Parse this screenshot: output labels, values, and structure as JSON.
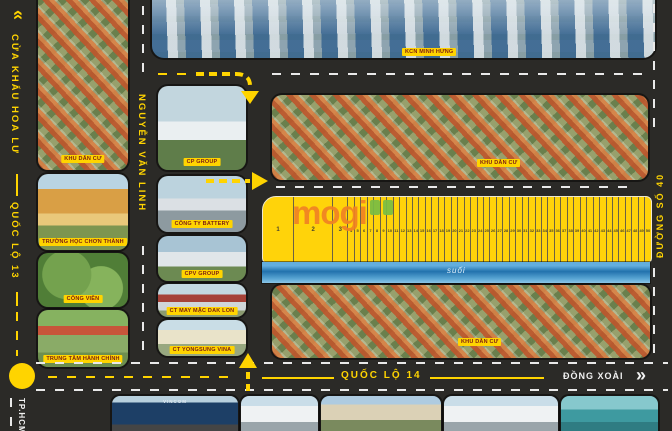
{
  "roads": {
    "border_gate": "CỬA KHẨU HOA LƯ",
    "highway13": "QUỐC LỘ 13",
    "nguyen_van_linh": "NGUYỄN VĂN LINH",
    "street40": "ĐƯỜNG SỐ 40",
    "highway14": "QUỐC LỘ 14",
    "dest_right": "ĐỒNG XOÀI",
    "dest_bottom_left": "TP.HCM",
    "chevron_up": "»",
    "chevron_right": "»"
  },
  "landmarks": {
    "industrial_zone": "KCN MINH HƯNG",
    "residential_left": "KHU DÂN CƯ",
    "school": "TRƯỜNG HỌC CHƠN THÀNH",
    "park": "CÔNG VIÊN",
    "admin_center": "TRUNG TÂM HÀNH CHÍNH",
    "cp_group": "CP GROUP",
    "battery_company": "CÔNG TY BATTERY",
    "cpv_group": "CPV GROUP",
    "garment_company": "CT MAY MẶC DAK LON",
    "yongsung_company": "CT YONGSUNG VINA",
    "residential_top": "KHU DÂN CƯ",
    "residential_bottom": "KHU DÂN CƯ",
    "stream": "suối",
    "vincom": "VINCOM"
  },
  "plots": {
    "numbers": [
      1,
      2,
      3,
      4,
      5,
      6,
      7,
      8,
      9,
      10,
      11,
      12,
      13,
      14,
      15,
      16,
      17,
      18,
      19,
      20,
      21,
      22,
      23,
      24,
      25,
      26,
      27,
      28,
      29,
      30,
      31,
      32,
      33,
      34,
      35,
      36,
      37,
      38,
      39,
      40,
      41,
      42,
      43,
      44,
      45,
      46,
      47,
      48,
      49,
      50
    ]
  },
  "watermark": {
    "text": "mogi"
  },
  "colors": {
    "accent": "#ffd400",
    "road": "#2b2a27",
    "plot_fill": "#ffd30a",
    "stream_blue": "#2272ad",
    "caption_text": "#7c1d12",
    "watermark_orange": "#f08223",
    "watermark_green": "#79bd44"
  }
}
